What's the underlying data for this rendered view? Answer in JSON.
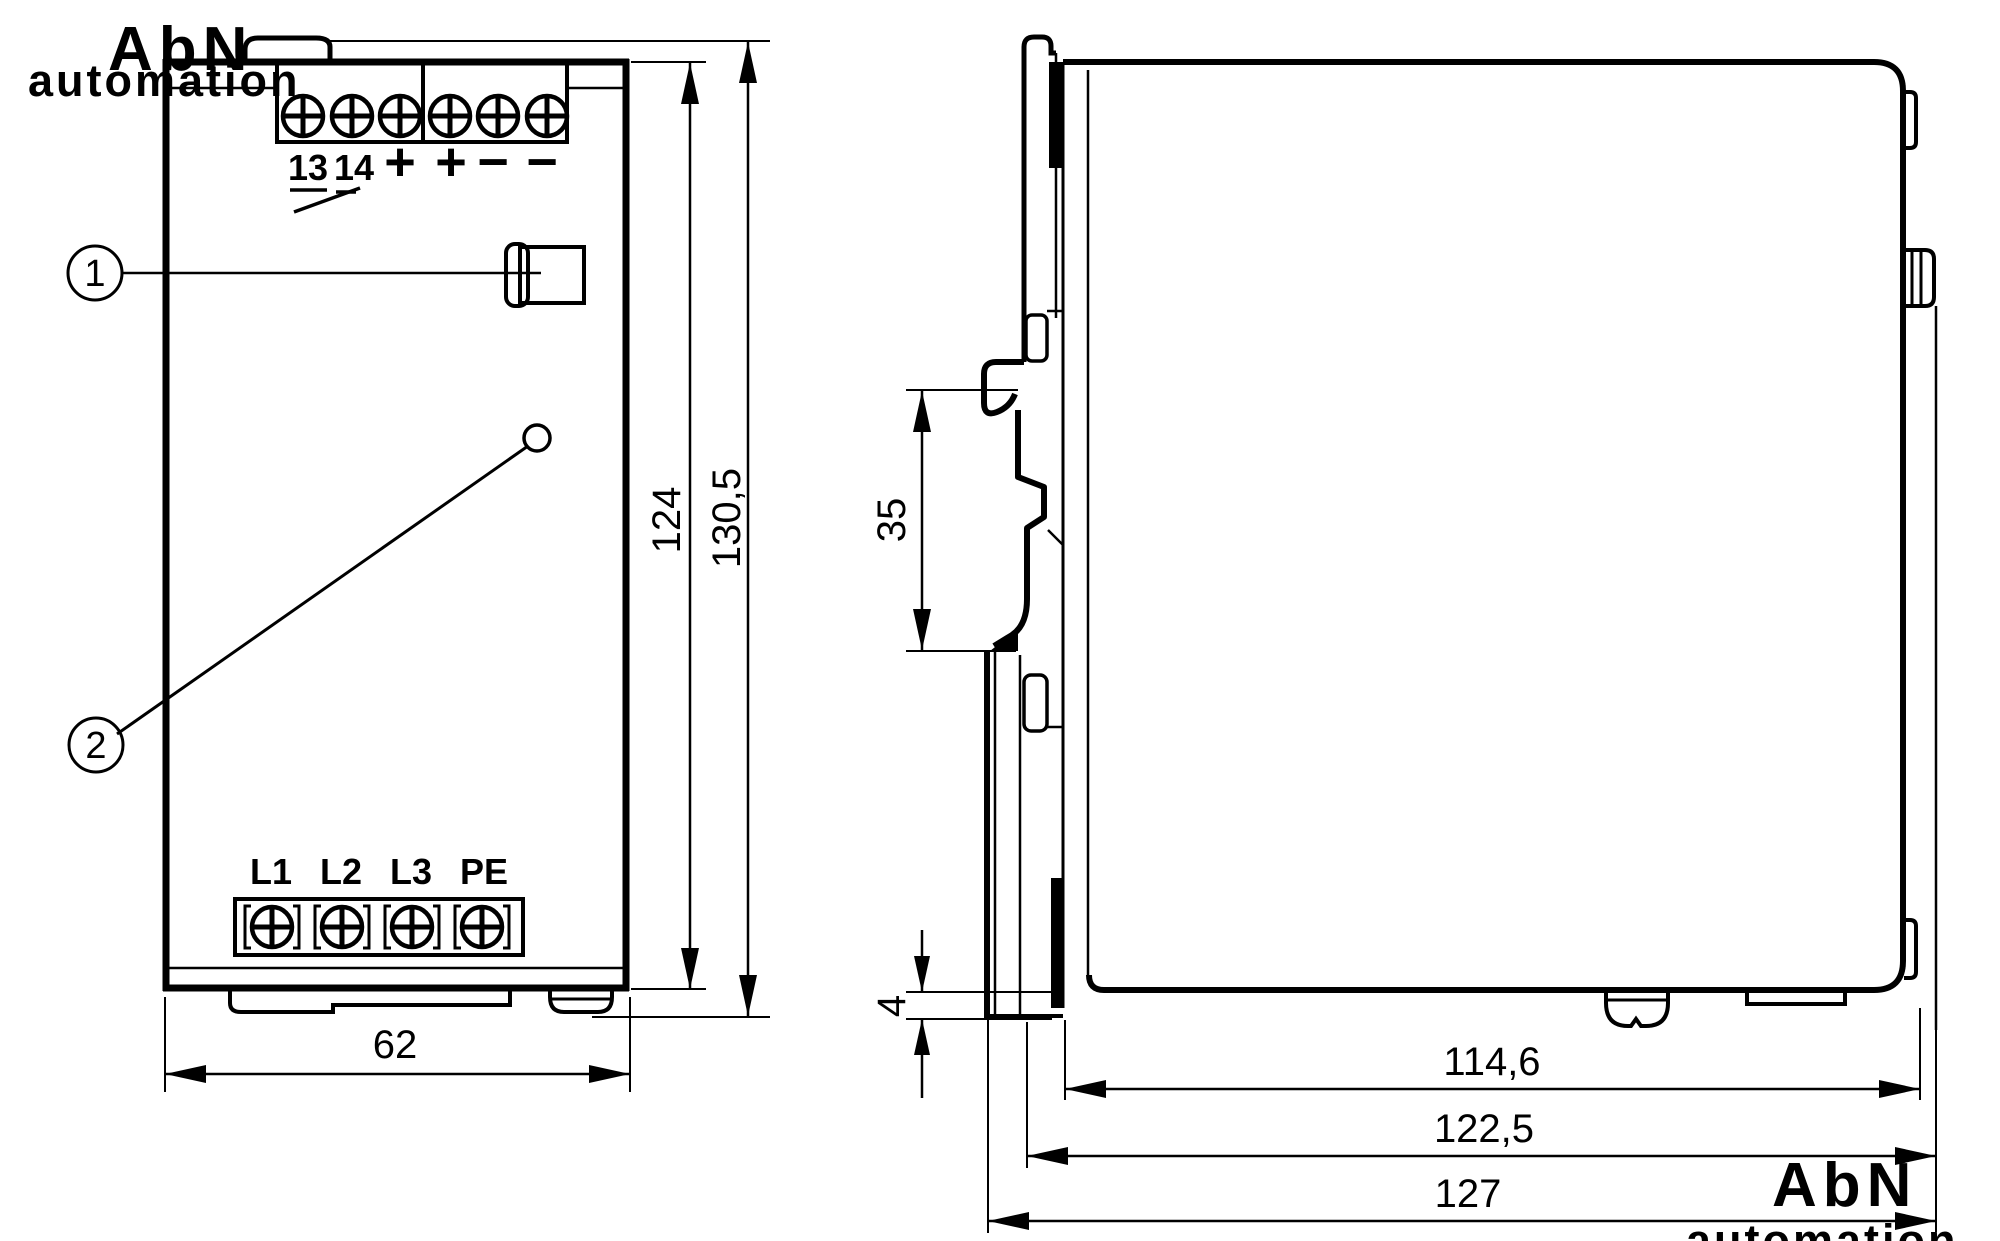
{
  "watermark": {
    "line1": "AbN",
    "line2": "automation"
  },
  "front_view": {
    "output_terminal_labels": [
      "13",
      "14",
      "+",
      "+",
      "−",
      "−"
    ],
    "input_terminal_labels": [
      "L1",
      "L2",
      "L3",
      "PE"
    ],
    "callouts": [
      "1",
      "2"
    ],
    "dim_width": "62",
    "dim_body_height": "124",
    "dim_overall_height": "130,5"
  },
  "side_view": {
    "dim_rail": "35",
    "dim_foot": "4",
    "dim_depth_body": "114,6",
    "dim_depth_housing": "122,5",
    "dim_depth_overall": "127"
  },
  "colors": {
    "line": "#000000",
    "background": "#ffffff",
    "watermark": "#ebebeb"
  }
}
